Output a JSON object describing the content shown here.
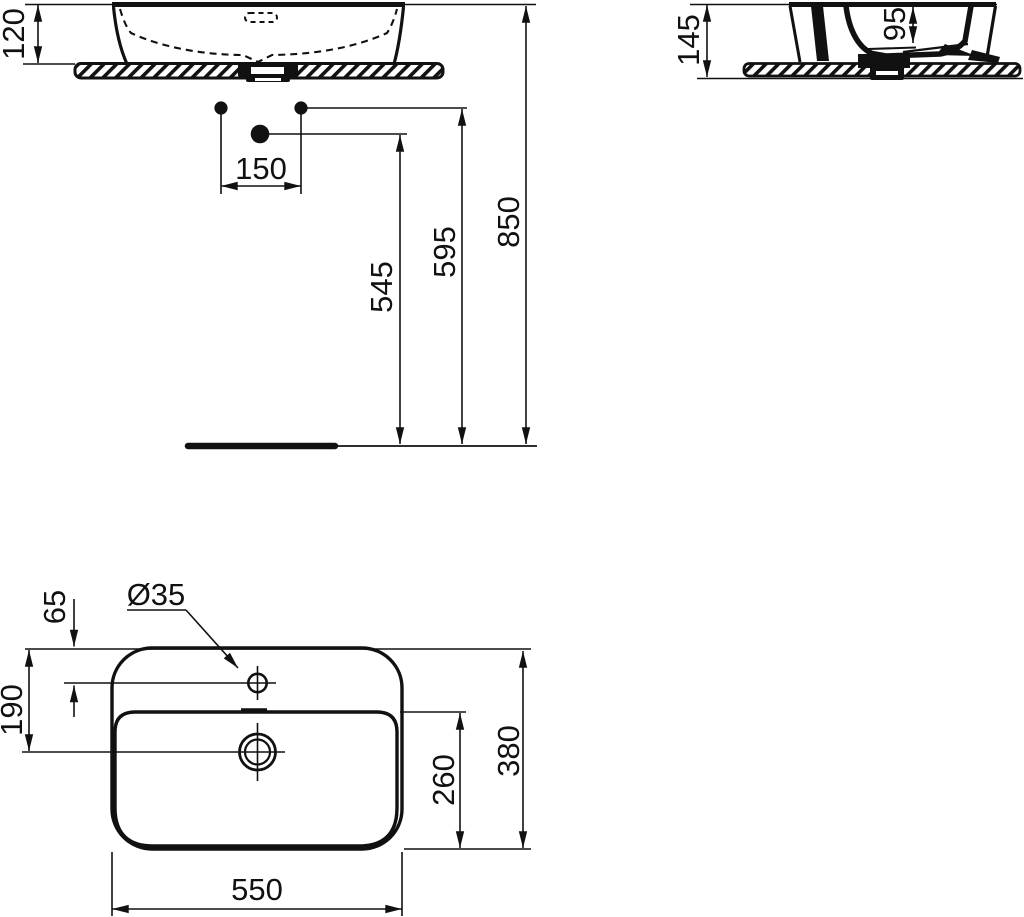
{
  "page": {
    "background": "#ffffff",
    "line_color": "#111111"
  },
  "views": {
    "front": {
      "dimensions": {
        "basin_height": "120",
        "tap_hole_spacing": "150",
        "lower_point_height": "545",
        "upper_points_height": "595",
        "rim_height": "850"
      }
    },
    "side": {
      "dimensions": {
        "total_height": "145",
        "bowl_depth": "95"
      }
    },
    "plan": {
      "dimensions": {
        "faucet_hole_diameter": "Ø35",
        "hole_offset": "65",
        "drain_offset": "190",
        "bowl_depth": "260",
        "overall_depth": "380",
        "overall_width": "550"
      }
    }
  }
}
